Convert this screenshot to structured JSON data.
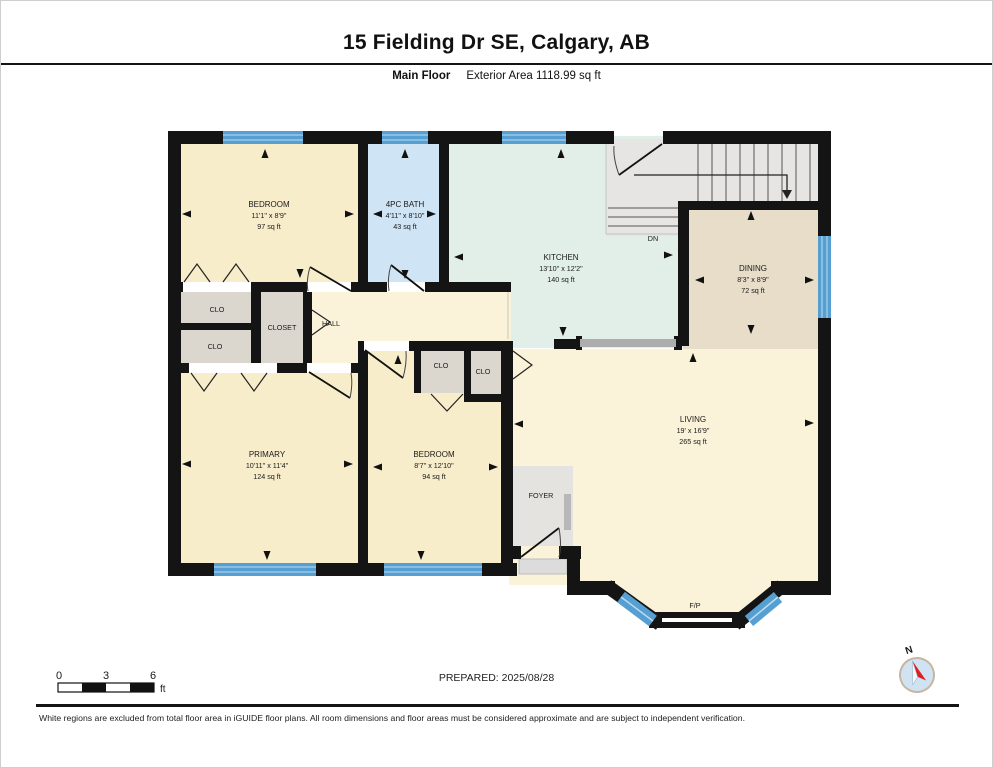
{
  "header": {
    "title": "15 Fielding Dr SE, Calgary, AB",
    "floor_label": "Main Floor",
    "area_label": "Exterior Area 1118.99 sq ft"
  },
  "rooms": {
    "bedroom1": {
      "name": "BEDROOM",
      "dims": "11'1\" x 8'9\"",
      "area": "97 sq ft"
    },
    "bath": {
      "name": "4PC BATH",
      "dims": "4'11\" x 8'10\"",
      "area": "43 sq ft"
    },
    "kitchen": {
      "name": "KITCHEN",
      "dims": "13'10\" x 12'2\"",
      "area": "140 sq ft"
    },
    "dining": {
      "name": "DINING",
      "dims": "8'3\" x 8'9\"",
      "area": "72 sq ft"
    },
    "primary": {
      "name": "PRIMARY",
      "dims": "10'11\" x 11'4\"",
      "area": "124 sq ft"
    },
    "bedroom2": {
      "name": "BEDROOM",
      "dims": "8'7\" x 12'10\"",
      "area": "94 sq ft"
    },
    "living": {
      "name": "LIVING",
      "dims": "19' x 16'9\"",
      "area": "265 sq ft"
    }
  },
  "labels": {
    "hall": "HALL",
    "closet": "CLOSET",
    "clo": "CLO",
    "foyer": "FOYER",
    "down": "DN",
    "fireplace": "F/P"
  },
  "scale_bar": {
    "zero": "0",
    "three": "3",
    "six": "6",
    "unit": "ft"
  },
  "prepared": "PREPARED: 2025/08/28",
  "compass": {
    "north": "N"
  },
  "footer": "White regions are excluded from total floor area in iGUIDE floor plans. All room dimensions and floor areas must be considered approximate and are subject to independent verification.",
  "colors": {
    "bedroom_fill": "#f8edca",
    "living_hall_fill": "#fbf3d9",
    "bath_fill": "#cfe4f4",
    "kitchen_fill": "#e2efe9",
    "dining_fill": "#e7ddc9",
    "closet_fill": "#dbd6ce",
    "foyer_stairs_fill": "#e6e5e3",
    "window_blue": "#569fd2",
    "wall_black": "#141414",
    "compass_red": "#e02020"
  }
}
